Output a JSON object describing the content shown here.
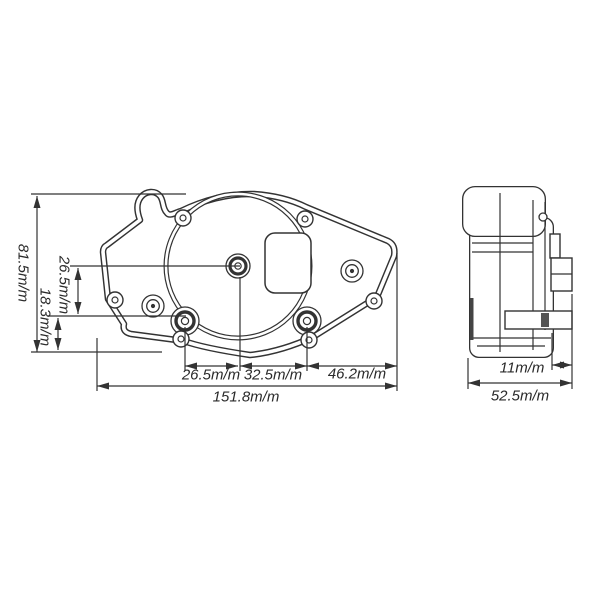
{
  "drawing": {
    "background": "#ffffff",
    "line_color": "#333333",
    "text_color": "#2a2a2a",
    "unit_suffix": "m/m",
    "front_view": {
      "description": "gauge rear housing front elevation",
      "dims": {
        "total_height": "81.5m/m",
        "center_to_mounts": "26.5m/m",
        "mounts_to_bottom": "18.3m/m",
        "left_mount_to_center": "26.5m/m",
        "center_to_right_mount": "32.5m/m",
        "right_mount_to_edge": "46.2m/m",
        "total_width": "151.8m/m"
      }
    },
    "side_view": {
      "description": "gauge housing side profile",
      "dims": {
        "connector_depth": "11m/m",
        "total_depth": "52.5m/m"
      }
    }
  }
}
